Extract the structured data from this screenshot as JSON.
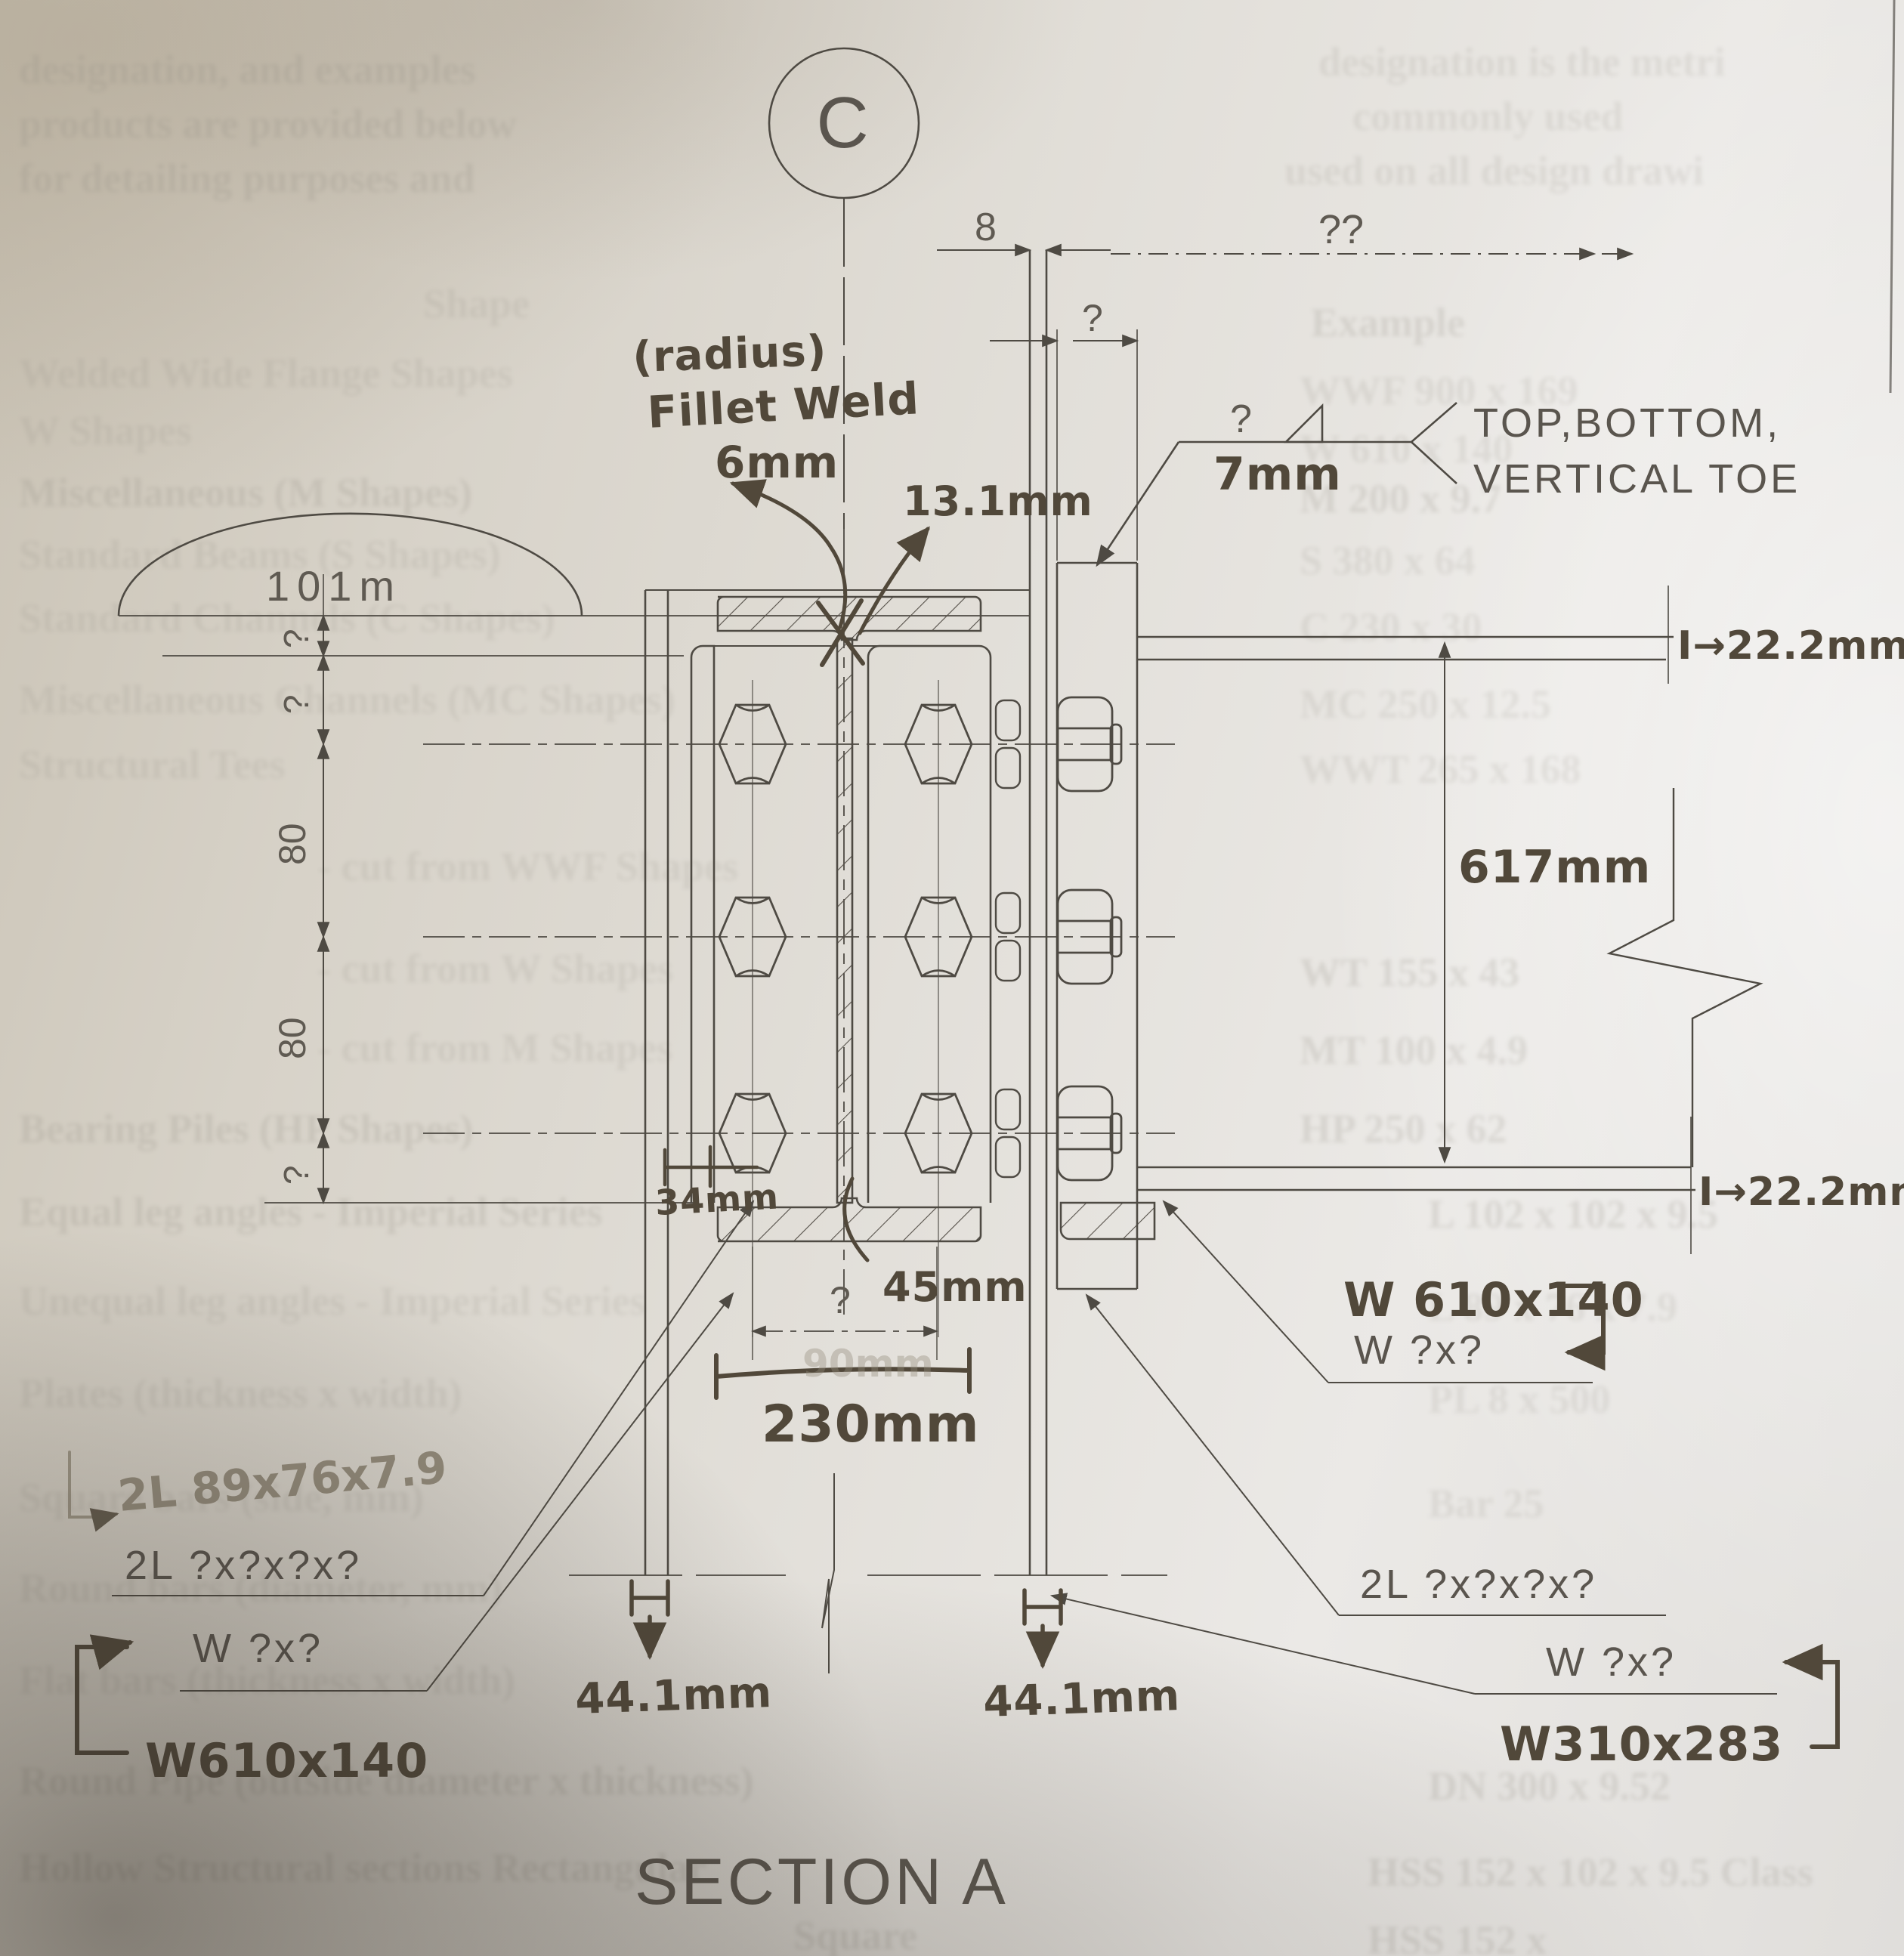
{
  "title": {
    "section_title": "SECTION A",
    "detail_bubble": "C"
  },
  "dimensions": {
    "arc_label": "101m",
    "left_chain": {
      "g1": "?",
      "g2": "?",
      "g3": "80",
      "g4": "80",
      "g5": "?"
    },
    "top_gap": "8",
    "top_unknown": "??",
    "top_plate_width": "?",
    "beam_depth": "617mm",
    "flange_thickness_top": "I→22.2mm",
    "flange_thickness_bottom": "I→22.2mm",
    "web_thickness": "13.1mm",
    "edge_distance_small": "34mm",
    "edge_distance_mid": "45mm",
    "bolt_gauge_unknown": "?",
    "bolt_gauge_ghost": "90mm",
    "spread": "230mm",
    "col_flange_left": "44.1mm",
    "col_flange_right": "44.1mm"
  },
  "weld": {
    "radius_note": "(radius)",
    "fillet_label": "Fillet Weld",
    "fillet_size": "6mm",
    "size_query": "?",
    "size_value": "7mm",
    "note_line1": "TOP,BOTTOM,",
    "note_line2": "VERTICAL TOE"
  },
  "labels": {
    "pencil_angles": "2L 89x76x7.9",
    "angles_left_q": "2L ?x?x?x?",
    "beam_left_q": "W ?x?",
    "beam_left_ans": "W610x140",
    "beam_right_ans": "W 610x140",
    "beam_right_q": "W ?x?",
    "angles_right_q": "2L ?x?x?x?",
    "column_q": "W ?x?",
    "column_ans": "W310x283"
  },
  "ghost_text": {
    "para_l1": "designation, and examples",
    "para_r1": "designation is the metri",
    "para_l2": "products are provided below",
    "para_r2": "commonly used",
    "para_l3": "for detailing purposes and",
    "para_r3": "used on all design drawi",
    "header_left": "Shape",
    "header_right": "Example",
    "rows": [
      {
        "left": "Welded Wide Flange Shapes",
        "right": "WWF 900 x 169"
      },
      {
        "left": "W Shapes",
        "right": "W 610 x 140"
      },
      {
        "left": "Miscellaneous (M Shapes)",
        "right": "M 200 x 9.7"
      },
      {
        "left": "Standard Beams (S Shapes)",
        "right": "S 380 x 64"
      },
      {
        "left": "Standard Channels (C Shapes)",
        "right": "C 230 x 30"
      },
      {
        "left": "Miscellaneous Channels (MC Shapes)",
        "right": "MC 250 x 12.5"
      },
      {
        "left": "Structural Tees",
        "right": "WWT 265 x 168"
      },
      {
        "left": "- cut from WWF Shapes",
        "right": ""
      },
      {
        "left": "- cut from W Shapes",
        "right": "WT 155 x 43"
      },
      {
        "left": "- cut from M Shapes",
        "right": "MT 100 x 4.9"
      },
      {
        "left": "Bearing Piles (HP Shapes)",
        "right": "HP 250 x 62"
      },
      {
        "left": "Equal leg angles      - Imperial Series",
        "right": "L 102 x 102 x 9.5"
      },
      {
        "left": "Unequal leg angles - Imperial Series",
        "right": "L 89 x 76 x 7.9"
      },
      {
        "left": "Plates (thickness x width)",
        "right": "PL 8 x 500"
      },
      {
        "left": "Square bars (side, mm)",
        "right": "Bar 25"
      },
      {
        "left": "Round bars (diameter, mm)",
        "right": "Bar 30"
      },
      {
        "left": "Flat bars (thickness x width)",
        "right": "Bar 6 x 50"
      },
      {
        "left": "Round Pipe (outside diameter x thickness)",
        "right": "DN 300 x 9.52"
      },
      {
        "left": "Hollow Structural sections    Rectangular",
        "right": "HSS 152 x 102 x 9.5 Class"
      },
      {
        "left": "Square",
        "right": "HSS 152 x"
      }
    ]
  },
  "colors": {
    "print_line": "#4e4a43",
    "hand_ink": "#51483a",
    "pencil": "#948c7c",
    "paper": "#e2dfd9"
  }
}
